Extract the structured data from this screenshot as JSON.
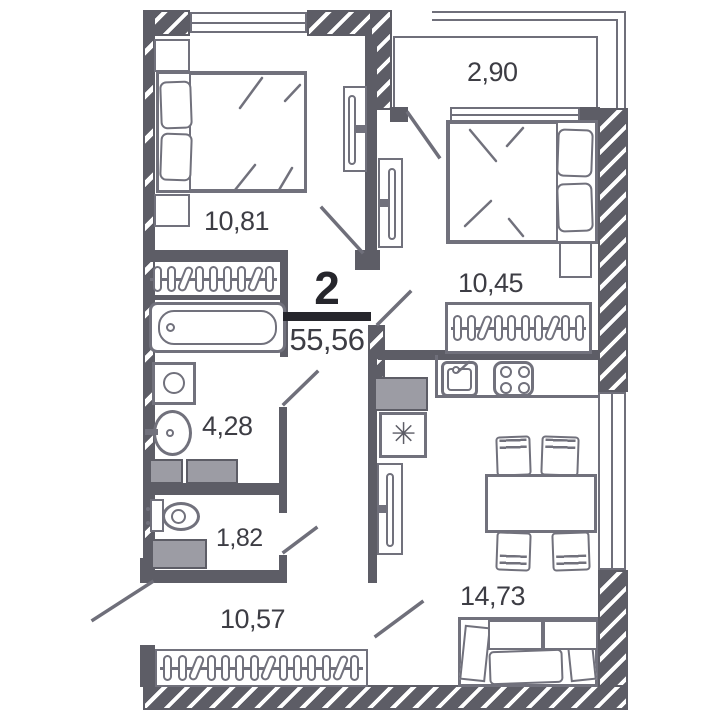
{
  "plan": {
    "summary": {
      "rooms_count": "2",
      "total_area": "55,56"
    },
    "rooms": [
      {
        "id": "bedroom-1",
        "area": "10,81"
      },
      {
        "id": "balcony",
        "area": "2,90"
      },
      {
        "id": "bedroom-2",
        "area": "10,45"
      },
      {
        "id": "bathroom",
        "area": "4,28"
      },
      {
        "id": "wc",
        "area": "1,82"
      },
      {
        "id": "hallway",
        "area": "10,57"
      },
      {
        "id": "kitchen-living",
        "area": "14,73"
      }
    ],
    "symbols": {
      "fridge": "✳"
    },
    "colors": {
      "wall": "#5d5d66",
      "line": "#71717c",
      "gray_fill": "#9c9ca4",
      "text": "#3d3d44",
      "accent": "#26262c"
    }
  }
}
